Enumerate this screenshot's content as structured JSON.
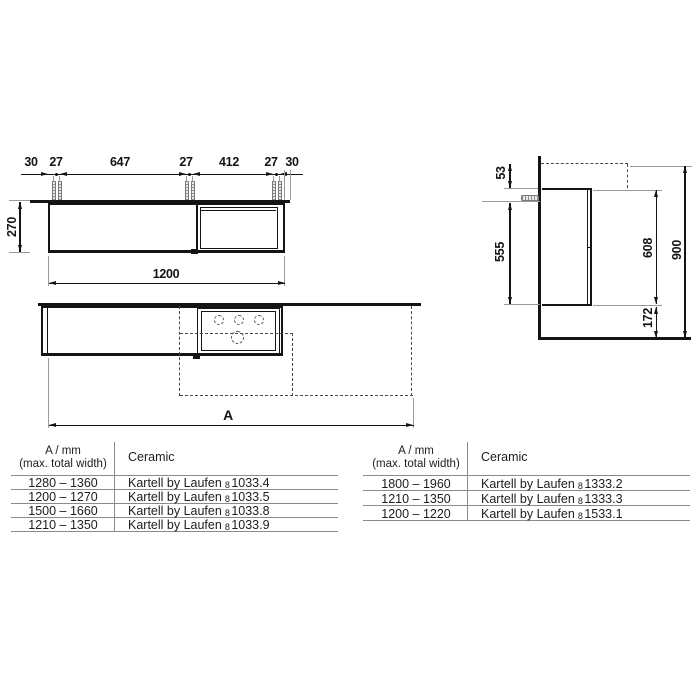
{
  "front_view": {
    "top_dims": [
      "30",
      "27",
      "647",
      "27",
      "412",
      "27",
      "30"
    ],
    "height_dim": "270",
    "width_dim": "1200"
  },
  "variant_view": {
    "total_width_dim": "A"
  },
  "side_view": {
    "countertop_offset_dim": "53",
    "fixing_height_dim": "555",
    "body_height_dim": "608",
    "total_height_dim": "900",
    "bottom_gap_dim": "172"
  },
  "tables": {
    "left": {
      "header_col1_line1": "A / mm",
      "header_col1_line2": "(max. total width)",
      "header_col2": "Ceramic",
      "rows": [
        {
          "range": "1280 – 1360",
          "brand": "Kartell by Laufen",
          "article_prefix": "8",
          "article_code": "1033.4"
        },
        {
          "range": "1200 – 1270",
          "brand": "Kartell by Laufen",
          "article_prefix": "8",
          "article_code": "1033.5"
        },
        {
          "range": "1500 – 1660",
          "brand": "Kartell by Laufen",
          "article_prefix": "8",
          "article_code": "1033.8"
        },
        {
          "range": "1210 – 1350",
          "brand": "Kartell by Laufen",
          "article_prefix": "8",
          "article_code": "1033.9"
        }
      ]
    },
    "right": {
      "header_col1_line1": "A / mm",
      "header_col1_line2": "(max. total width)",
      "header_col2": "Ceramic",
      "rows": [
        {
          "range": "1800 – 1960",
          "brand": "Kartell by Laufen",
          "article_prefix": "8",
          "article_code": "1333.2"
        },
        {
          "range": "1210 – 1350",
          "brand": "Kartell by Laufen",
          "article_prefix": "8",
          "article_code": "1533.1_placeholder"
        },
        {
          "range": "1200 – 1220",
          "brand": "Kartell by Laufen",
          "article_prefix": "8",
          "article_code": "1533.1"
        }
      ]
    }
  }
}
